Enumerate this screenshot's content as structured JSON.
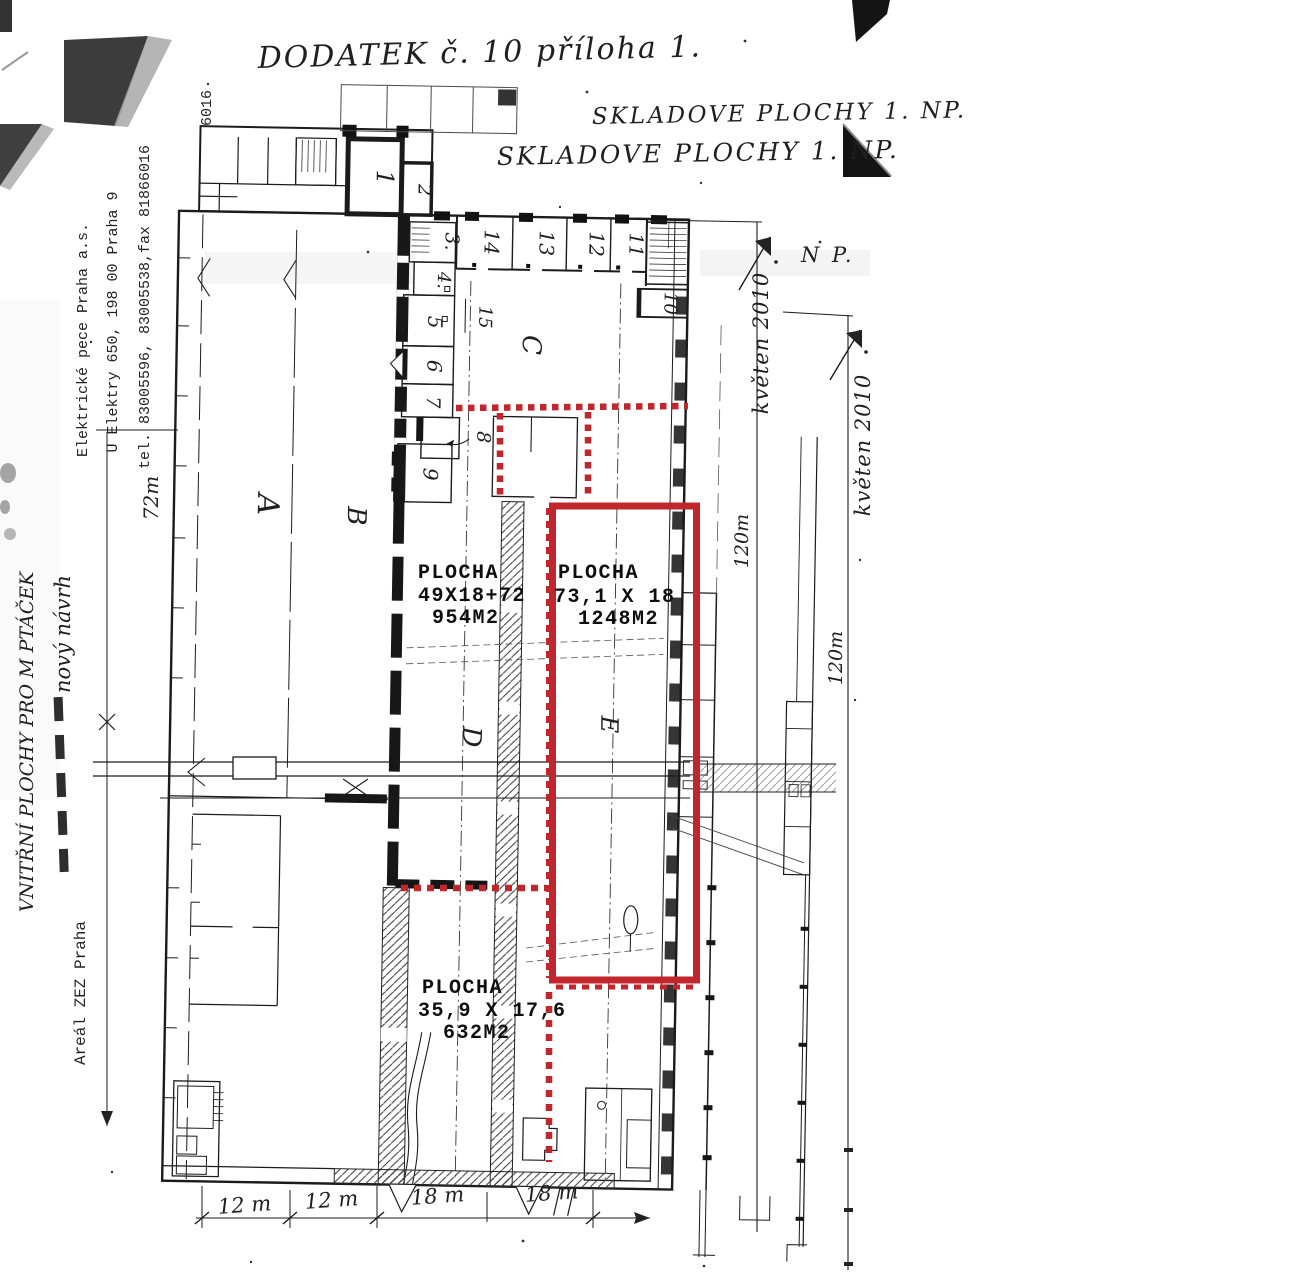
{
  "document": {
    "title": "DODATEK č. 10 příloha 1.",
    "skladove1": "SKLADOVE PLOCHY 1. NP.",
    "skladove2": "SKLADOVE PLOCHY 1. NP.",
    "np_fragment": "N P."
  },
  "letterhead": {
    "company": "Elektrické pece Praha a.s.",
    "address": "U Elektry 650, 198 00 Praha 9",
    "phone": "tel. 83005596, 83005538,fax 81866016",
    "fragment": "6016",
    "site": "Areál ZEZ Praha"
  },
  "notes": {
    "vnitrni": "VNITŘNÍ PLOCHY PRO M PTÁČEK",
    "novy": "nový návrh"
  },
  "areas": {
    "zone1": {
      "name": "PLOCHA",
      "dimensions": "49X18+72",
      "area": "954M2"
    },
    "zone2": {
      "name": "PLOCHA",
      "dimensions": "73,1 X 18",
      "area": "1248M2"
    },
    "zone3": {
      "name": "PLOCHA",
      "dimensions": "35,9 X 17,6",
      "area": "632M2"
    }
  },
  "rooms": {
    "r1": "1",
    "r2": "2",
    "r3": "3.",
    "r4": "4.",
    "r5": "5",
    "r6": "6",
    "r7": "7",
    "r8": "8",
    "r9": "9",
    "r10": "10",
    "r11": "11",
    "r12": "12",
    "r13": "13",
    "r14": "14",
    "r15": "15"
  },
  "halls": {
    "a": "A",
    "b": "B",
    "c": "C",
    "d": "D",
    "e": "E"
  },
  "dimensions": {
    "height_left": "72m",
    "date_note_1": "květen 2010",
    "length_right_1": "120m",
    "date_note_2": "květen 2010",
    "length_right_2": "120m",
    "bottom": {
      "d1": "12 m",
      "d2": "12 m",
      "d3": "18 m",
      "d4": "18 m"
    }
  },
  "colors": {
    "annotation_red": "#c0262c",
    "ink_black": "#1b1b1b"
  }
}
